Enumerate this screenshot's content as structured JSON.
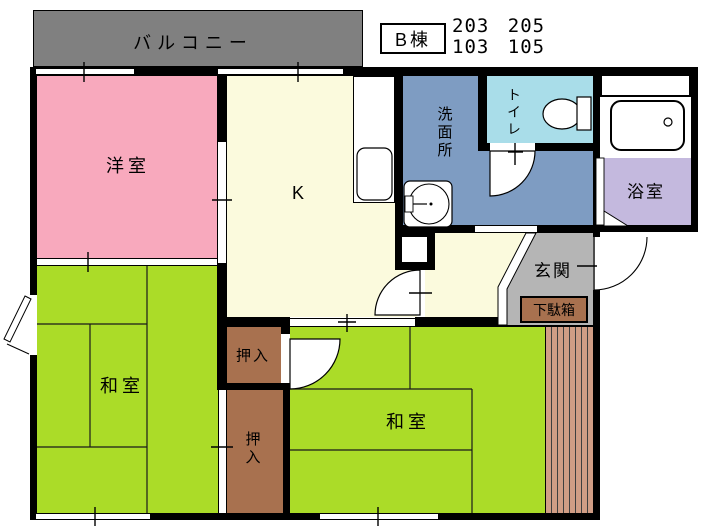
{
  "header": {
    "building_label": "B棟",
    "units_row1": "203 205",
    "units_row2": "103 105"
  },
  "rooms": {
    "balcony": {
      "label": "バルコニー",
      "color": "#808080"
    },
    "western_room": {
      "label": "洋室",
      "color": "#f8a9bd"
    },
    "kitchen": {
      "label": "K",
      "color": "#fbfadd"
    },
    "washroom": {
      "label": "洗面所",
      "color": "#7e9cc2"
    },
    "toilet": {
      "label": "トイレ",
      "color": "#a9dde9"
    },
    "bathroom": {
      "label": "浴室",
      "color": "#c4b9de"
    },
    "entrance": {
      "label": "玄関",
      "color": "#b5b5b5"
    },
    "shoe_cabinet": {
      "label": "下駄箱",
      "color": "#a8714f"
    },
    "closet_upper": {
      "label": "押入",
      "color": "#a8714f"
    },
    "closet_lower": {
      "label": "押入",
      "color": "#a8714f"
    },
    "japanese_room_left": {
      "label": "和室",
      "color": "#abdc28"
    },
    "japanese_room_right": {
      "label": "和室",
      "color": "#abdc28"
    }
  },
  "colors": {
    "wall": "#000000",
    "background": "#ffffff",
    "wood_strip": "#d09d85",
    "fixture_fill": "#ffffff"
  }
}
